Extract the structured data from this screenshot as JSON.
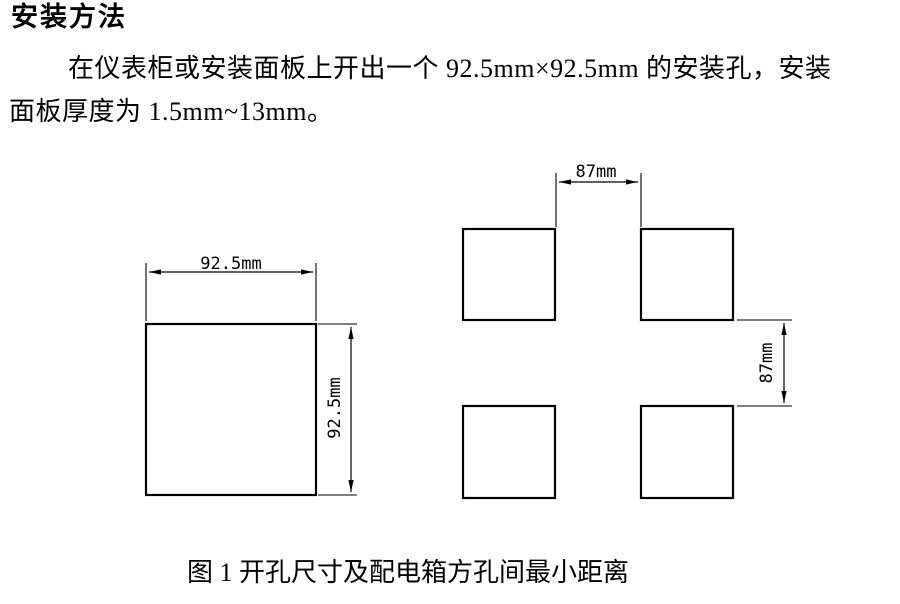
{
  "document": {
    "heading": "安装方法",
    "body_line1": "在仪表柜或安装面板上开出一个 92.5mm×92.5mm 的安装孔，安装",
    "body_line2": "面板厚度为 1.5mm~13mm。",
    "figure_caption": "图 1 开孔尺寸及配电箱方孔间最小距离"
  },
  "figure": {
    "single_cutout": {
      "width_label": "92.5mm",
      "height_label": "92.5mm"
    },
    "spacing_grid": {
      "horizontal_spacing_label": "87mm",
      "vertical_spacing_label": "87mm"
    }
  },
  "colors": {
    "background": "#ffffff",
    "ink": "#000000"
  }
}
